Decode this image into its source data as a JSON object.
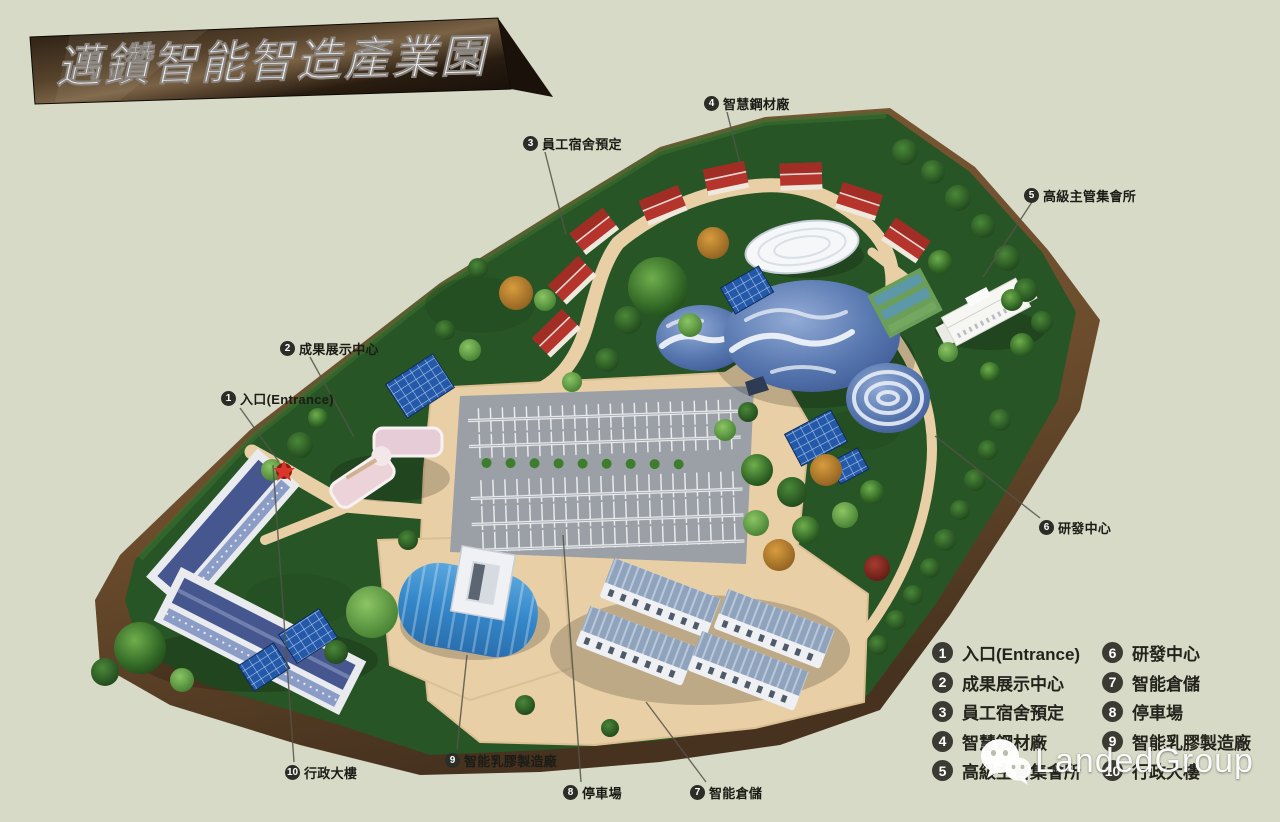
{
  "banner": {
    "title": "邁鑽智能智造產業園"
  },
  "map": {
    "callouts": [
      {
        "num": "1",
        "text": "入口(Entrance)"
      },
      {
        "num": "2",
        "text": "成果展示中心"
      },
      {
        "num": "3",
        "text": "員工宿舍預定"
      },
      {
        "num": "4",
        "text": "智慧鋼材廠"
      },
      {
        "num": "5",
        "text": "高級主管集會所"
      },
      {
        "num": "6",
        "text": "研發中心"
      },
      {
        "num": "7",
        "text": "智能倉儲"
      },
      {
        "num": "8",
        "text": "停車場"
      },
      {
        "num": "9",
        "text": "智能乳膠製造廠"
      },
      {
        "num": "10",
        "text": "行政大樓"
      }
    ]
  },
  "legend": {
    "col1": [
      {
        "num": "1",
        "text": "入口(Entrance)"
      },
      {
        "num": "2",
        "text": "成果展示中心"
      },
      {
        "num": "3",
        "text": "員工宿舍預定"
      },
      {
        "num": "4",
        "text": "智慧鋼材廠"
      },
      {
        "num": "5",
        "text": "高級主管集會所"
      }
    ],
    "col2": [
      {
        "num": "6",
        "text": "研發中心"
      },
      {
        "num": "7",
        "text": "智能倉儲"
      },
      {
        "num": "8",
        "text": "停車場"
      },
      {
        "num": "9",
        "text": "智能乳膠製造廠"
      },
      {
        "num": "10",
        "text": "行政大樓"
      }
    ]
  },
  "watermark": {
    "text": "LandedGroup"
  },
  "icons": {
    "watermark_logo": "wechat-bubbles-icon",
    "entrance_marker": "red-star-icon"
  },
  "palette": {
    "background": "#d7dac6",
    "banner_bronze": "#57432c",
    "grass": "#285526",
    "dirt": "#6e5131",
    "road": "#e8cfa5",
    "parking": "#9aa0a6",
    "dome_blue": "#4a6aa5",
    "house_roof_red": "#b5342b",
    "legend_circle": "#3b3b33",
    "watermark_white": "#ffffff"
  }
}
